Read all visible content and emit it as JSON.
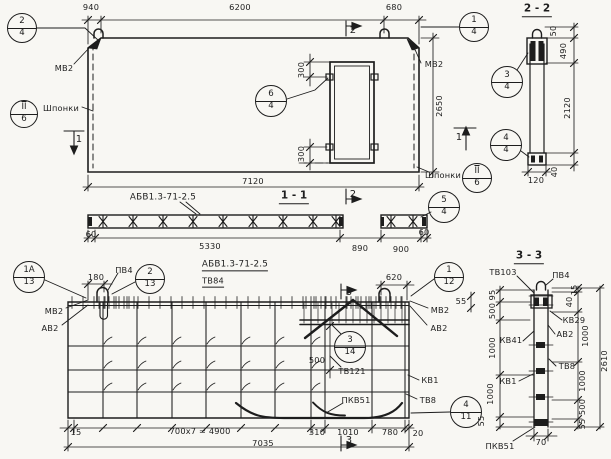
{
  "style": {
    "background": "#f8f7f3",
    "ink": "#1d1d1d"
  },
  "views": {
    "elevation": {
      "labels": [
        {
          "id": "dim-940",
          "text": "940",
          "x": 91,
          "y": 7
        },
        {
          "id": "dim-6200",
          "text": "6200",
          "x": 240,
          "y": 7
        },
        {
          "id": "dim-680",
          "text": "680",
          "x": 394,
          "y": 7
        },
        {
          "id": "label-mv2-top-left",
          "text": "МВ2",
          "x": 64,
          "y": 68
        },
        {
          "id": "label-shponki-left",
          "text": "Шпонки",
          "x": 61,
          "y": 108
        },
        {
          "id": "marker-1-left",
          "text": "1",
          "x": 79,
          "y": 140,
          "fs": 10
        },
        {
          "id": "marker-2-top",
          "text": "2",
          "x": 353,
          "y": 31,
          "fs": 10
        },
        {
          "id": "label-mv2-top-right",
          "text": "МВ2",
          "x": 434,
          "y": 64
        },
        {
          "id": "dim-300-door-top",
          "text": "300",
          "x": 301,
          "y": 70,
          "rot": -90
        },
        {
          "id": "dim-300-door-bottom",
          "text": "300",
          "x": 301,
          "y": 154,
          "rot": -90
        },
        {
          "id": "dim-2650",
          "text": "2650",
          "x": 439,
          "y": 106,
          "rot": -90
        },
        {
          "id": "label-shponki-right",
          "text": "Шпонки",
          "x": 443,
          "y": 175
        },
        {
          "id": "marker-1-right",
          "text": "1",
          "x": 459,
          "y": 138,
          "fs": 10
        },
        {
          "id": "dim-7120",
          "text": "7120",
          "x": 253,
          "y": 181
        },
        {
          "id": "marker-2-bottom",
          "text": "2",
          "x": 353,
          "y": 195,
          "fs": 10
        }
      ],
      "callouts": [
        {
          "id": "callout-2-4",
          "top": "2",
          "bottom": "4",
          "x": 22,
          "y": 28,
          "r": 15
        },
        {
          "id": "callout-1-4",
          "top": "1",
          "bottom": "4",
          "x": 474,
          "y": 27,
          "r": 15
        },
        {
          "id": "callout-6-4",
          "top": "6",
          "bottom": "4",
          "x": 271,
          "y": 101,
          "r": 16
        },
        {
          "id": "callout-sh-6-left",
          "top": "II",
          "bottom": "6",
          "x": 24,
          "y": 114,
          "r": 14,
          "ovl": true
        },
        {
          "id": "callout-sh-6-right",
          "top": "II",
          "bottom": "6",
          "x": 477,
          "y": 178,
          "r": 15,
          "ovl": true
        }
      ]
    },
    "section_1_1": {
      "title": {
        "id": "title-1-1",
        "text": "1 - 1",
        "x": 294,
        "y": 197
      },
      "labels": [
        {
          "id": "label-abv-top",
          "text": "АБВ1.3-71-2.5",
          "x": 163,
          "y": 198,
          "fs": 8.8
        },
        {
          "id": "dim-60-left",
          "text": "60",
          "x": 91,
          "y": 234
        },
        {
          "id": "dim-5330",
          "text": "5330",
          "x": 210,
          "y": 246
        },
        {
          "id": "dim-890",
          "text": "890",
          "x": 360,
          "y": 248
        },
        {
          "id": "dim-900",
          "text": "900",
          "x": 401,
          "y": 249
        },
        {
          "id": "dim-60-right",
          "text": "60",
          "x": 424,
          "y": 232
        }
      ],
      "callouts": [
        {
          "id": "callout-5-4",
          "top": "5",
          "bottom": "4",
          "x": 444,
          "y": 207,
          "r": 16
        }
      ]
    },
    "section_2_2": {
      "title": {
        "id": "title-2-2",
        "text": "2 - 2",
        "x": 537,
        "y": 10
      },
      "labels": [
        {
          "id": "dim-50",
          "text": "50",
          "x": 553,
          "y": 31,
          "rot": -90
        },
        {
          "id": "dim-490",
          "text": "490",
          "x": 563,
          "y": 51,
          "rot": -90
        },
        {
          "id": "dim-2120",
          "text": "2120",
          "x": 567,
          "y": 108,
          "rot": -90
        },
        {
          "id": "dim-40",
          "text": "40",
          "x": 554,
          "y": 172,
          "rot": -90
        },
        {
          "id": "dim-120",
          "text": "120",
          "x": 536,
          "y": 180
        }
      ],
      "callouts": [
        {
          "id": "callout-3-4",
          "top": "3",
          "bottom": "4",
          "x": 507,
          "y": 82,
          "r": 16
        },
        {
          "id": "callout-4-4",
          "top": "4",
          "bottom": "4",
          "x": 506,
          "y": 145,
          "r": 16
        }
      ]
    },
    "reinforcement": {
      "labels": [
        {
          "id": "dim-180",
          "text": "180",
          "x": 96,
          "y": 277
        },
        {
          "id": "label-pv4-left",
          "text": "ПВ4",
          "x": 124,
          "y": 270
        },
        {
          "id": "label-abv-bottom",
          "text": "АБВ1.3-71-2.5",
          "x": 235,
          "y": 266,
          "ul": true,
          "fs": 8.8
        },
        {
          "id": "label-tv84",
          "text": "ТВ84",
          "x": 213,
          "y": 282,
          "ul": true
        },
        {
          "id": "label-mv2-left",
          "text": "МВ2",
          "x": 54,
          "y": 311
        },
        {
          "id": "label-av2-left",
          "text": "АВ2",
          "x": 50,
          "y": 328
        },
        {
          "id": "dim-620",
          "text": "620",
          "x": 394,
          "y": 277
        },
        {
          "id": "marker-3-top",
          "text": "3",
          "x": 349,
          "y": 293,
          "fs": 10
        },
        {
          "id": "label-mv2-right",
          "text": "МВ2",
          "x": 440,
          "y": 310
        },
        {
          "id": "label-av2-right",
          "text": "АВ2",
          "x": 439,
          "y": 328
        },
        {
          "id": "dim-500-inner",
          "text": "500",
          "x": 317,
          "y": 360
        },
        {
          "id": "label-tv121",
          "text": "ТВ121",
          "x": 352,
          "y": 371
        },
        {
          "id": "label-kv1",
          "text": "КВ1",
          "x": 430,
          "y": 380
        },
        {
          "id": "label-tv8",
          "text": "ТВ8",
          "x": 428,
          "y": 400
        },
        {
          "id": "label-pkv51",
          "text": "ПКВ51",
          "x": 356,
          "y": 400
        },
        {
          "id": "dim-15",
          "text": "15",
          "x": 76,
          "y": 432
        },
        {
          "id": "dim-700x7",
          "text": "700x7 = 4900",
          "x": 200,
          "y": 431
        },
        {
          "id": "dim-310",
          "text": "310",
          "x": 317,
          "y": 432
        },
        {
          "id": "dim-1010",
          "text": "1010",
          "x": 348,
          "y": 432
        },
        {
          "id": "dim-780",
          "text": "780",
          "x": 390,
          "y": 432
        },
        {
          "id": "dim-20",
          "text": "20",
          "x": 418,
          "y": 433
        },
        {
          "id": "dim-7035",
          "text": "7035",
          "x": 263,
          "y": 443
        },
        {
          "id": "marker-3-bottom",
          "text": "3",
          "x": 349,
          "y": 441,
          "fs": 10
        }
      ],
      "callouts": [
        {
          "id": "callout-1a-13",
          "top": "1А",
          "bottom": "13",
          "x": 29,
          "y": 277,
          "r": 16
        },
        {
          "id": "callout-2-13",
          "top": "2",
          "bottom": "13",
          "x": 150,
          "y": 279,
          "r": 15
        },
        {
          "id": "callout-3-14",
          "top": "3",
          "bottom": "14",
          "x": 350,
          "y": 347,
          "r": 16
        },
        {
          "id": "callout-1-12",
          "top": "1",
          "bottom": "12",
          "x": 449,
          "y": 277,
          "r": 15
        },
        {
          "id": "callout-4-11",
          "top": "4",
          "bottom": "11",
          "x": 466,
          "y": 412,
          "r": 16
        }
      ]
    },
    "section_3_3": {
      "title": {
        "id": "title-3-3",
        "text": "3 - 3",
        "x": 529,
        "y": 257
      },
      "labels": [
        {
          "id": "label-tv103",
          "text": "ТВ103",
          "x": 503,
          "y": 272
        },
        {
          "id": "label-pv4-33",
          "text": "ПВ4",
          "x": 561,
          "y": 275
        },
        {
          "id": "dim-95",
          "text": "95",
          "x": 492,
          "y": 295,
          "rot": -90
        },
        {
          "id": "dim-55-top",
          "text": "55",
          "x": 461,
          "y": 301
        },
        {
          "id": "dim-500-left",
          "text": "500",
          "x": 492,
          "y": 311,
          "rot": -90
        },
        {
          "id": "dim-1000-left-1",
          "text": "1000",
          "x": 492,
          "y": 348,
          "rot": -90
        },
        {
          "id": "dim-1000-left-2",
          "text": "1000",
          "x": 490,
          "y": 394,
          "rot": -90
        },
        {
          "id": "dim-55-left",
          "text": "55",
          "x": 481,
          "y": 421,
          "rot": -90
        },
        {
          "id": "dim-15-right",
          "text": "15",
          "x": 574,
          "y": 290,
          "rot": -90
        },
        {
          "id": "dim-40-right",
          "text": "40",
          "x": 569,
          "y": 302,
          "rot": -90
        },
        {
          "id": "dim-1000-right-1",
          "text": "1000",
          "x": 585,
          "y": 336,
          "rot": -90
        },
        {
          "id": "dim-1000-right-2",
          "text": "1000",
          "x": 582,
          "y": 381,
          "rot": -90
        },
        {
          "id": "dim-500-right",
          "text": "500",
          "x": 582,
          "y": 407,
          "rot": -90
        },
        {
          "id": "dim-55-right",
          "text": "55",
          "x": 582,
          "y": 424,
          "rot": -90
        },
        {
          "id": "dim-2610",
          "text": "2610",
          "x": 604,
          "y": 361,
          "rot": -90
        },
        {
          "id": "label-kv29",
          "text": "КВ29",
          "x": 574,
          "y": 320
        },
        {
          "id": "label-av2-33",
          "text": "АВ2",
          "x": 565,
          "y": 334
        },
        {
          "id": "label-kv41",
          "text": "КВ41",
          "x": 511,
          "y": 340
        },
        {
          "id": "label-tv8-33",
          "text": "ТВ8",
          "x": 567,
          "y": 366
        },
        {
          "id": "label-kv1-33",
          "text": "КВ1",
          "x": 508,
          "y": 381
        },
        {
          "id": "dim-70",
          "text": "70",
          "x": 541,
          "y": 442
        },
        {
          "id": "label-pkv51-33",
          "text": "ПКВ51",
          "x": 500,
          "y": 446
        }
      ],
      "callouts": []
    }
  }
}
